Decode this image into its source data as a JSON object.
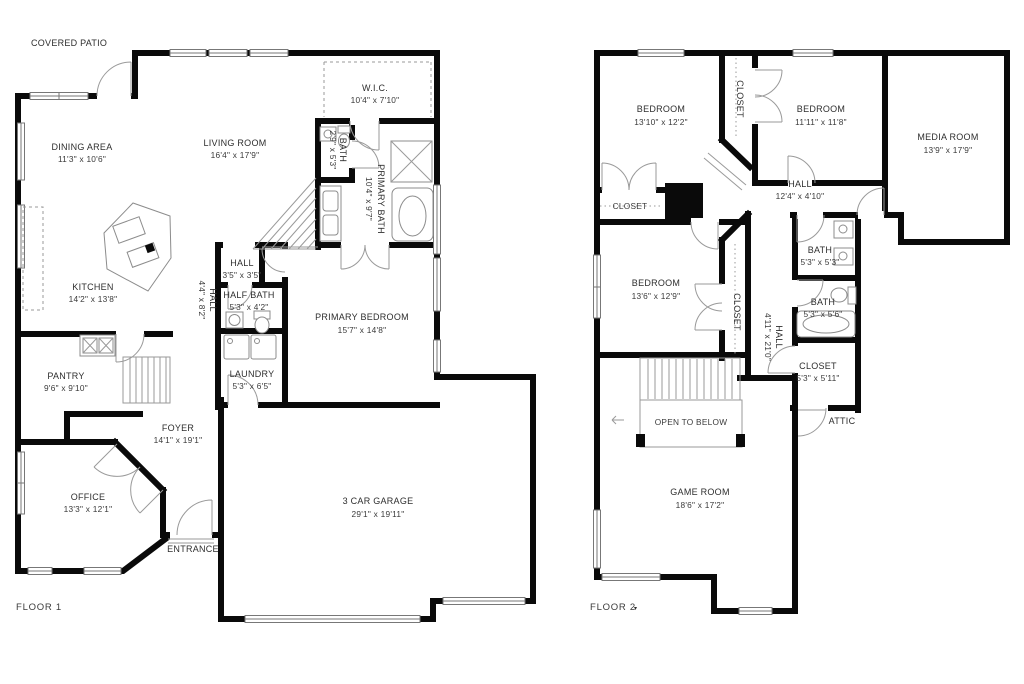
{
  "colors": {
    "wall": "#0a0a0a",
    "thin_line": "#9a9a9a",
    "text": "#2e2e2e",
    "background": "#ffffff"
  },
  "labels": {
    "covered_patio": "COVERED PATIO",
    "floor1": "FLOOR 1",
    "floor2": "FLOOR 2",
    "floor2_marker": "▾",
    "entrance": "ENTRANCE",
    "attic": "ATTIC",
    "open_to_below": "OPEN TO BELOW"
  },
  "floor1": {
    "dining": {
      "name": "DINING AREA",
      "dims": "11'3\" x 10'6\""
    },
    "living": {
      "name": "LIVING ROOM",
      "dims": "16'4\" x 17'9\""
    },
    "wic": {
      "name": "W.I.C.",
      "dims": "10'4\" x 7'10\""
    },
    "bath": {
      "name": "BATH",
      "dims": "2'9\" x 5'3\""
    },
    "primary_bath": {
      "name": "PRIMARY BATH",
      "dims": "10'4\" x 9'7\""
    },
    "kitchen": {
      "name": "KITCHEN",
      "dims": "14'2\" x 13'8\""
    },
    "hall_corridor": {
      "name": "HALL",
      "dims": "4'4\" x 8'2\""
    },
    "hall": {
      "name": "HALL",
      "dims": "3'5\" x 3'5\""
    },
    "half_bath": {
      "name": "HALF BATH",
      "dims": "5'3\" x 4'2\""
    },
    "primary_bedroom": {
      "name": "PRIMARY BEDROOM",
      "dims": "15'7\" x 14'8\""
    },
    "laundry": {
      "name": "LAUNDRY",
      "dims": "5'3\" x 6'5\""
    },
    "pantry": {
      "name": "PANTRY",
      "dims": "9'6\" x 9'10\""
    },
    "foyer": {
      "name": "FOYER",
      "dims": "14'1\" x 19'1\""
    },
    "office": {
      "name": "OFFICE",
      "dims": "13'3\" x 12'1\""
    },
    "garage": {
      "name": "3 CAR GARAGE",
      "dims": "29'1\" x 19'11\""
    }
  },
  "floor2": {
    "bedroom1": {
      "name": "BEDROOM",
      "dims": "13'10\" x 12'2\""
    },
    "closet_strip": {
      "name": "CLOSET"
    },
    "bedroom2": {
      "name": "BEDROOM",
      "dims": "11'11\" x 11'8\""
    },
    "media_room": {
      "name": "MEDIA ROOM",
      "dims": "13'9\" x 17'9\""
    },
    "hall1": {
      "name": "HALL",
      "dims": "12'4\" x 4'10\""
    },
    "closet_bed1": {
      "name": "CLOSET"
    },
    "bedroom3": {
      "name": "BEDROOM",
      "dims": "13'6\" x 12'9\""
    },
    "closet_bed3": {
      "name": "CLOSET"
    },
    "bath1": {
      "name": "BATH",
      "dims": "5'3\" x 5'3\""
    },
    "bath2": {
      "name": "BATH",
      "dims": "5'3\" x 5'6\""
    },
    "hall2": {
      "name": "HALL",
      "dims": "4'11\" x 21'0\""
    },
    "closet_hall": {
      "name": "CLOSET",
      "dims": "5'3\" x 5'11\""
    },
    "game_room": {
      "name": "GAME ROOM",
      "dims": "18'6\" x 17'2\""
    }
  }
}
